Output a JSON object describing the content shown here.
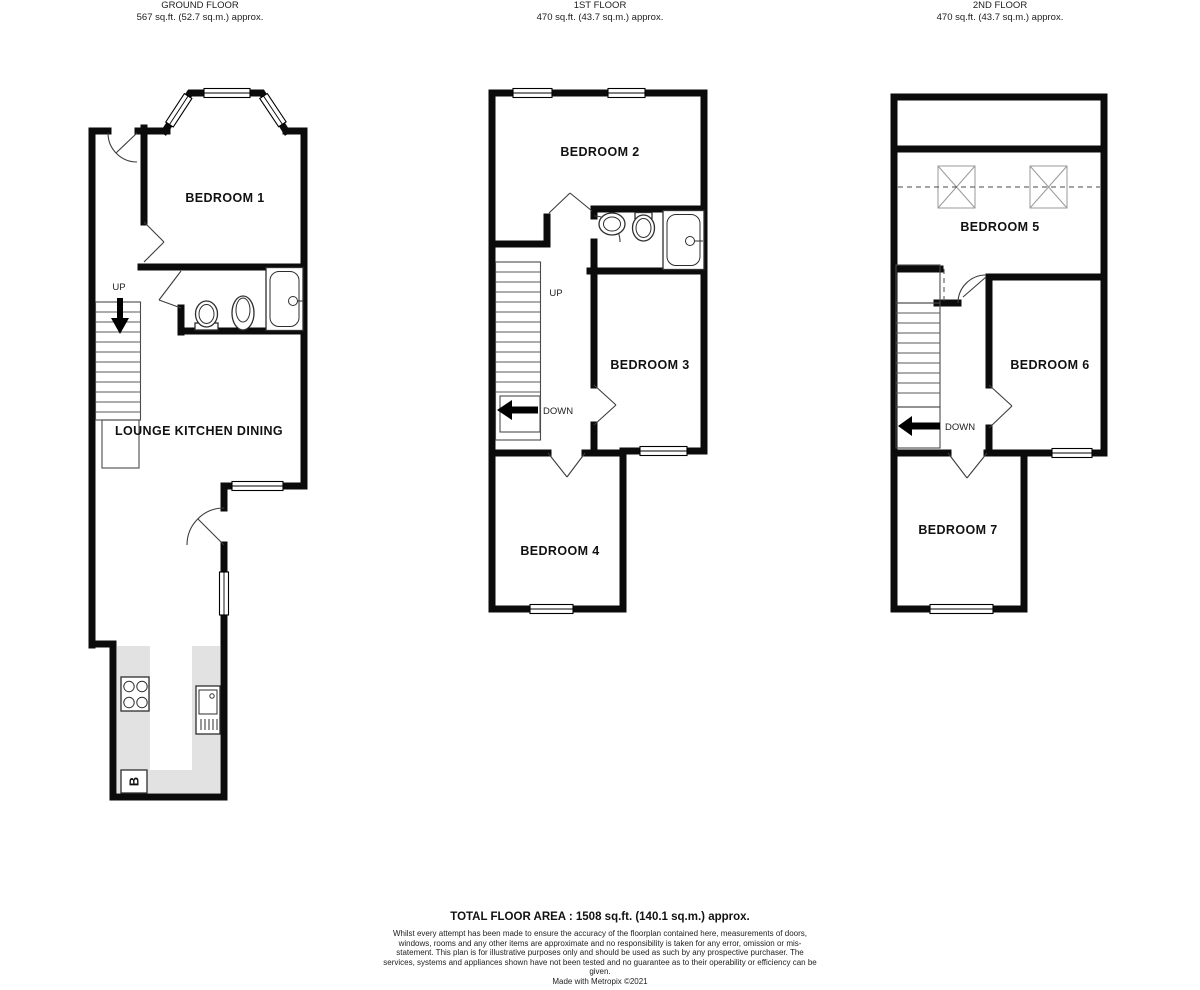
{
  "floors": [
    {
      "title": "GROUND FLOOR",
      "area": "567 sq.ft. (52.7 sq.m.) approx.",
      "rooms": [
        "BEDROOM 1",
        "LOUNGE KITCHEN DINING"
      ],
      "labels": {
        "up": "UP",
        "boiler": "B"
      }
    },
    {
      "title": "1ST FLOOR",
      "area": "470 sq.ft. (43.7 sq.m.) approx.",
      "rooms": [
        "BEDROOM 2",
        "BEDROOM 3",
        "BEDROOM 4"
      ],
      "labels": {
        "up": "UP",
        "down": "DOWN"
      }
    },
    {
      "title": "2ND FLOOR",
      "area": "470 sq.ft. (43.7 sq.m.) approx.",
      "rooms": [
        "BEDROOM 5",
        "BEDROOM 6",
        "BEDROOM 7"
      ],
      "labels": {
        "down": "DOWN"
      }
    }
  ],
  "footer": {
    "total": "TOTAL FLOOR AREA : 1508 sq.ft. (140.1 sq.m.) approx.",
    "disclaimer": "Whilst every attempt has been made to ensure the accuracy of the floorplan contained here, measurements of doors, windows, rooms and any other items are approximate and no responsibility is taken for any error, omission or mis-statement. This plan is for illustrative purposes only and should be used as such by any prospective purchaser. The services, systems and appliances shown have not been tested and no guarantee as to their operability or efficiency can be given.",
    "credit": "Made with Metropix ©2021"
  },
  "colors": {
    "wall": "#0b0b0b",
    "counter": "#e2e2e2"
  }
}
